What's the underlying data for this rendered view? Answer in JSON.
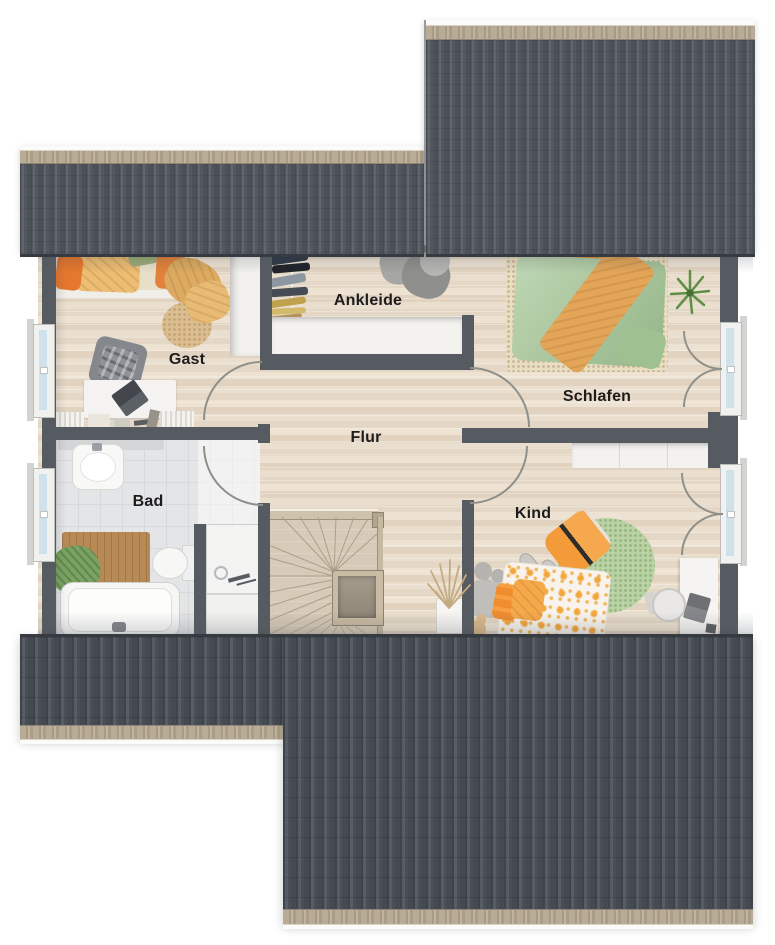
{
  "floorplan": {
    "type": "residential upper floor plan, top-down 3D render",
    "rooms": [
      {
        "id": "gast",
        "label": "Gast"
      },
      {
        "id": "ankleide",
        "label": "Ankleide"
      },
      {
        "id": "schlafen",
        "label": "Schlafen"
      },
      {
        "id": "flur",
        "label": "Flur"
      },
      {
        "id": "bad",
        "label": "Bad"
      },
      {
        "id": "kind",
        "label": "Kind"
      }
    ]
  },
  "palette": {
    "roof_dark": "#4c5158",
    "roof_rib_light": "#61666e",
    "eave_tan": "#b2a58f",
    "wall_gray": "#565b62",
    "wood_floor": "#e7dbc9",
    "stair_wood": "#d6cab8",
    "tile_floor": "#e4e5e7",
    "accent_orange": "#e8923a",
    "duvet_green": "#a9c99b",
    "rug_green": "#b9d3a4",
    "rug_beige": "#e9ddc2",
    "window_glass": "#cfe2ec",
    "door_arc_gray": "#8f8f89"
  }
}
